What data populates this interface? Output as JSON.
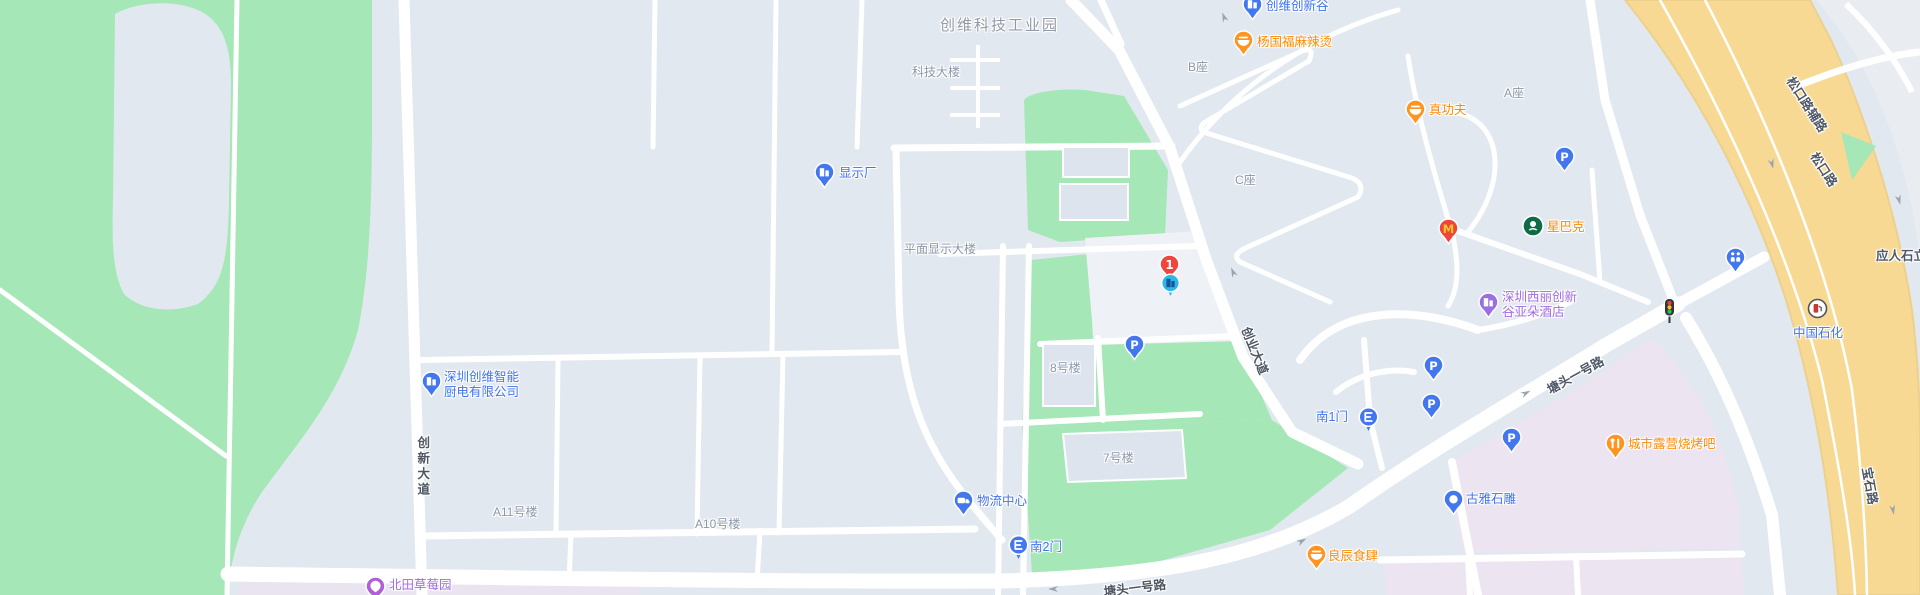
{
  "map": {
    "colors": {
      "base": "#e2e8f0",
      "park_green": "#a5e7b6",
      "road_white": "#ffffff",
      "highway_yellow": "#f8d994",
      "highway_edge": "#ecd08e",
      "pink_block": "#ece4f1",
      "lavender_block": "#eae4f0",
      "plaza": "#eef2f7",
      "building_fill": "#dde4ee",
      "arrow_gray": "#9aa4af",
      "markers": {
        "blue": "#4377ee",
        "orange": "#ff9421",
        "purple": "#9a6fe0",
        "violet": "#b05fd8",
        "red": "#f0453b",
        "cyan": "#2fb6e9",
        "green": "#0e6b45",
        "white": "#ffffff",
        "dark": "#32373d",
        "mcdonalds_m": "#ffc72c",
        "cyan_glyph": "#15559c",
        "sinopec_red": "#c8382e"
      }
    },
    "labels": [
      {
        "name": "label-chuangwei-tech-industrial-park",
        "text": "创维科技工业园",
        "type": "area",
        "x": 940,
        "y": 17,
        "interactable": false
      },
      {
        "name": "label-keji-building",
        "text": "科技大楼",
        "type": "building",
        "x": 912,
        "y": 65,
        "interactable": false
      },
      {
        "name": "label-flat-display-building",
        "text": "平面显示大楼",
        "type": "building",
        "x": 904,
        "y": 242,
        "interactable": false
      },
      {
        "name": "label-block-b",
        "text": "B座",
        "type": "building",
        "x": 1188,
        "y": 60,
        "interactable": false
      },
      {
        "name": "label-block-c",
        "text": "C座",
        "type": "building",
        "x": 1235,
        "y": 173,
        "interactable": false
      },
      {
        "name": "label-block-a",
        "text": "A座",
        "type": "building",
        "x": 1504,
        "y": 86,
        "interactable": false
      },
      {
        "name": "label-building-8",
        "text": "8号楼",
        "type": "building",
        "x": 1050,
        "y": 361,
        "interactable": false
      },
      {
        "name": "label-building-7",
        "text": "7号楼",
        "type": "building",
        "x": 1103,
        "y": 451,
        "interactable": false
      },
      {
        "name": "label-building-a11",
        "text": "A11号楼",
        "type": "building",
        "x": 493,
        "y": 505,
        "interactable": false
      },
      {
        "name": "label-building-a10",
        "text": "A10号楼",
        "type": "building",
        "x": 695,
        "y": 517,
        "interactable": false
      },
      {
        "name": "label-xianshichang",
        "text": "显示厂",
        "type": "poi-blue",
        "x": 839,
        "y": 166,
        "interactable": true
      },
      {
        "name": "label-logistics-center",
        "text": "物流中心",
        "type": "poi-blue",
        "x": 977,
        "y": 494,
        "interactable": true
      },
      {
        "name": "label-south-gate-2",
        "text": "南2门",
        "type": "poi-blue",
        "x": 1030,
        "y": 540,
        "interactable": true
      },
      {
        "name": "label-south-gate-1",
        "text": "南1门",
        "type": "poi-blue",
        "x": 1316,
        "y": 410,
        "interactable": true
      },
      {
        "name": "label-chuangwei-innovation-valley",
        "text": "创维创新谷",
        "type": "poi-blue",
        "x": 1266,
        "y": -1,
        "interactable": true
      },
      {
        "name": "label-yangguofu-malatang",
        "text": "杨国福麻辣烫",
        "type": "poi-orange",
        "x": 1257,
        "y": 35,
        "interactable": true
      },
      {
        "name": "label-zhengongfu",
        "text": "真功夫",
        "type": "poi-orange",
        "x": 1429,
        "y": 103,
        "interactable": true
      },
      {
        "name": "label-starbucks",
        "text": "星巴克",
        "type": "poi-orange",
        "x": 1547,
        "y": 220,
        "interactable": true
      },
      {
        "name": "label-atour-hotel",
        "text": "深圳西丽创新\n谷亚朵酒店",
        "type": "poi-purple",
        "x": 1502,
        "y": 290,
        "interactable": true
      },
      {
        "name": "label-chuangwei-smart-kitchen",
        "text": "深圳创维智能\n厨电有限公司",
        "type": "poi-blue",
        "x": 444,
        "y": 370,
        "interactable": true
      },
      {
        "name": "label-beitian-strawberry-garden",
        "text": "北田草莓园",
        "type": "poi-purple",
        "x": 389,
        "y": 578,
        "interactable": true
      },
      {
        "name": "label-guya-stone-carving",
        "text": "古雅石雕",
        "type": "poi-blue",
        "x": 1466,
        "y": 492,
        "interactable": true
      },
      {
        "name": "label-liangchen-restaurant",
        "text": "良辰食肆",
        "type": "poi-orange",
        "x": 1328,
        "y": 549,
        "interactable": true
      },
      {
        "name": "label-city-camping-bbq",
        "text": "城市露营烧烤吧",
        "type": "poi-orange",
        "x": 1628,
        "y": 437,
        "interactable": true
      },
      {
        "name": "label-sinopec",
        "text": "中国石化",
        "type": "poi-blue",
        "x": 1793,
        "y": 326,
        "interactable": true
      },
      {
        "name": "label-yingrenshi-interchange",
        "text": "应人石立交",
        "type": "road",
        "x": 1876,
        "y": 249,
        "interactable": false
      },
      {
        "name": "label-songkou-road-auxiliary",
        "text": "松口路辅路",
        "type": "road",
        "x": 1806,
        "y": 105,
        "rot": 57,
        "anchor": "center",
        "interactable": false
      },
      {
        "name": "label-songkou-road",
        "text": "松口路",
        "type": "road",
        "x": 1823,
        "y": 170,
        "rot": 57,
        "anchor": "center",
        "interactable": false
      },
      {
        "name": "label-baoshi-road",
        "text": "宝石路",
        "type": "road",
        "x": 1869,
        "y": 486,
        "rot": 80,
        "anchor": "center",
        "interactable": false
      },
      {
        "name": "label-tangtou-no1-road-south",
        "text": "塘头一号路",
        "type": "road",
        "x": 1135,
        "y": 589,
        "rot": -7,
        "anchor": "center",
        "interactable": false
      },
      {
        "name": "label-tangtou-no1-road-east",
        "text": "塘头一号路",
        "type": "road",
        "x": 1576,
        "y": 376,
        "rot": -29,
        "anchor": "center",
        "interactable": false
      },
      {
        "name": "label-chuangye-avenue",
        "text": "创业大道",
        "type": "road",
        "x": 1254,
        "y": 351,
        "rot": 68,
        "anchor": "center",
        "interactable": false
      },
      {
        "name": "label-chuangxin-avenue",
        "text": "创新大道",
        "type": "road-v",
        "x": 414,
        "y": 436,
        "interactable": false
      }
    ],
    "markers": [
      {
        "name": "marker-xianshichang",
        "icon": "pin-building",
        "color": "blue",
        "x": 824,
        "y": 172
      },
      {
        "name": "marker-chuangwei-innovation-valley",
        "icon": "pin-building",
        "color": "blue",
        "x": 1252,
        "y": 4
      },
      {
        "name": "marker-chuangwei-smart-kitchen",
        "icon": "pin-building",
        "color": "blue",
        "x": 431,
        "y": 381
      },
      {
        "name": "marker-logistics-center",
        "icon": "pin-truck",
        "color": "blue",
        "x": 963,
        "y": 500
      },
      {
        "name": "marker-south-gate-2",
        "icon": "gate",
        "color": "blue",
        "x": 1018,
        "y": 545
      },
      {
        "name": "marker-south-gate-1",
        "icon": "gate",
        "color": "blue",
        "x": 1368,
        "y": 417
      },
      {
        "name": "marker-guya-stone-carving",
        "icon": "pin-stone",
        "color": "blue",
        "x": 1453,
        "y": 499
      },
      {
        "name": "marker-atour-hotel",
        "icon": "pin-building",
        "color": "purple",
        "x": 1488,
        "y": 302
      },
      {
        "name": "marker-beitian-strawberry-garden",
        "icon": "pin-strawberry",
        "color": "violet",
        "x": 375,
        "y": 586
      },
      {
        "name": "marker-parking-a",
        "icon": "pin-p",
        "color": "blue",
        "x": 1564,
        "y": 156
      },
      {
        "name": "marker-parking-b",
        "icon": "pin-p",
        "color": "blue",
        "x": 1134,
        "y": 344
      },
      {
        "name": "marker-parking-c",
        "icon": "pin-p",
        "color": "blue",
        "x": 1433,
        "y": 365
      },
      {
        "name": "marker-parking-d",
        "icon": "pin-p",
        "color": "blue",
        "x": 1431,
        "y": 403
      },
      {
        "name": "marker-parking-e",
        "icon": "pin-p",
        "color": "blue",
        "x": 1511,
        "y": 437
      },
      {
        "name": "marker-yangguofu-malatang",
        "icon": "pin-bowl",
        "color": "orange",
        "x": 1243,
        "y": 40
      },
      {
        "name": "marker-zhengongfu",
        "icon": "pin-bowl",
        "color": "orange",
        "x": 1415,
        "y": 109
      },
      {
        "name": "marker-liangchen-restaurant",
        "icon": "pin-bowl",
        "color": "orange",
        "x": 1316,
        "y": 554
      },
      {
        "name": "marker-city-camping-bbq",
        "icon": "pin-grill",
        "color": "orange",
        "x": 1615,
        "y": 443
      },
      {
        "name": "marker-mcdonalds",
        "icon": "pin-mcdonalds",
        "color": "red",
        "x": 1448,
        "y": 228
      },
      {
        "name": "marker-starbucks",
        "icon": "starbucks",
        "color": "green",
        "x": 1533,
        "y": 226
      },
      {
        "name": "marker-route-point-1",
        "icon": "pin-number-1",
        "color": "red",
        "x": 1169,
        "y": 264
      },
      {
        "name": "marker-company-highlight",
        "icon": "cyan-building",
        "color": "cyan",
        "x": 1170,
        "y": 283
      },
      {
        "name": "marker-restroom",
        "icon": "pin-wc",
        "color": "blue",
        "x": 1735,
        "y": 257
      },
      {
        "name": "marker-sinopec-station",
        "icon": "gas-station",
        "color": "white",
        "x": 1817,
        "y": 308
      },
      {
        "name": "marker-traffic-light",
        "icon": "traffic-light",
        "color": "dark",
        "x": 1669,
        "y": 311
      }
    ]
  }
}
